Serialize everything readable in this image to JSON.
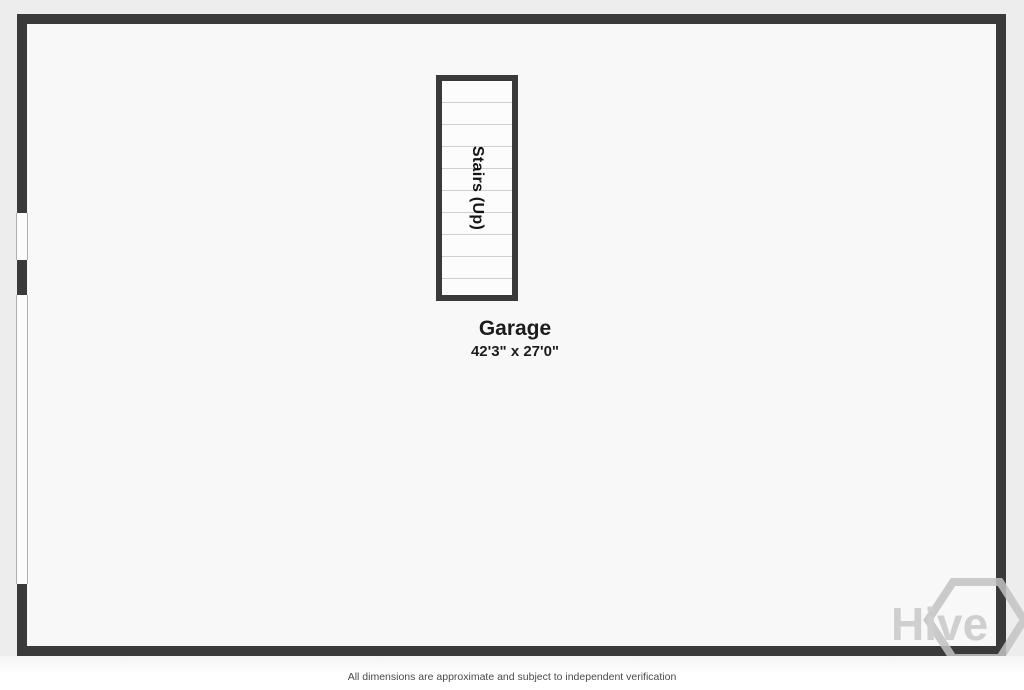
{
  "plan": {
    "room": {
      "name": "Garage",
      "dimensions": "42'3\" x 27'0\""
    },
    "stairs_label": "Stairs (Up)",
    "watermark_text": "Hive",
    "disclaimer": "All dimensions are approximate and subject to independent verification",
    "colors": {
      "wall": "#3a3a3a",
      "floor": "#f8f8f8",
      "page_background": "#ededed",
      "tread_line": "#cfcfcf",
      "watermark": "#c3c3c3",
      "label_text": "#1c1c1c"
    }
  }
}
